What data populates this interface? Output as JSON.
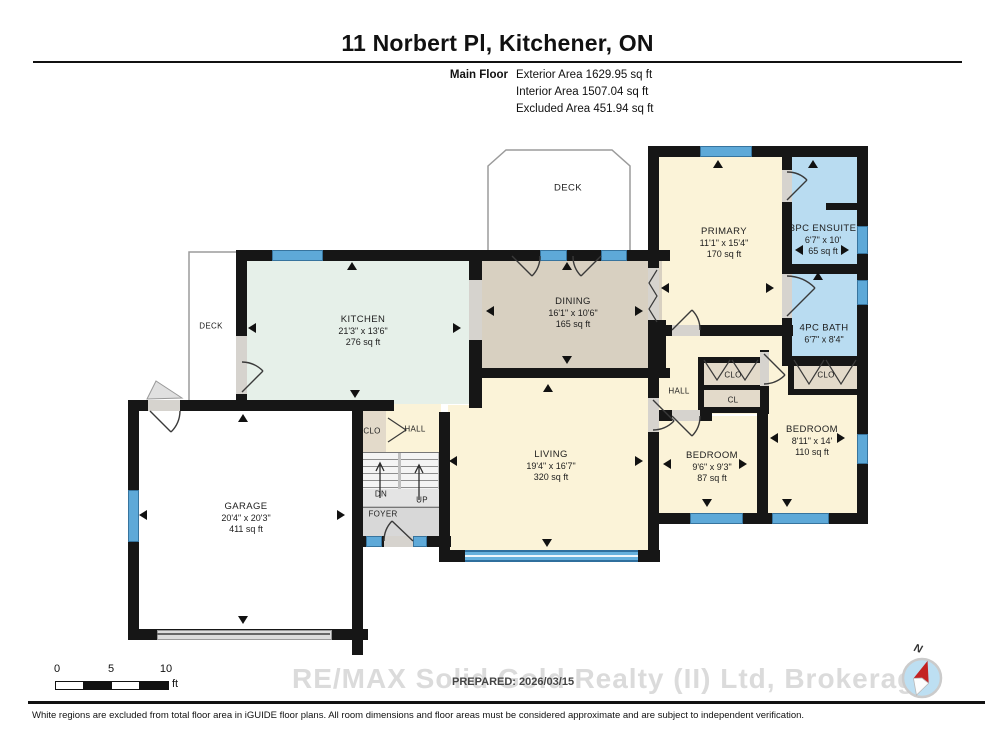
{
  "header": {
    "title": "11 Norbert Pl, Kitchener, ON",
    "floor_label": "Main Floor",
    "stats": [
      "Exterior Area 1629.95 sq ft",
      "Interior Area 1507.04 sq ft",
      "Excluded Area 451.94 sq ft"
    ]
  },
  "rooms": {
    "deck_top": {
      "name": "DECK"
    },
    "deck_left": {
      "name": "DECK"
    },
    "primary": {
      "name": "PRIMARY",
      "dims": "11'1\" x 15'4\"",
      "area": "170 sq ft"
    },
    "ensuite": {
      "name": "3PC ENSUITE",
      "dims": "6'7\" x 10'",
      "area": "65 sq ft"
    },
    "bath": {
      "name": "4PC BATH",
      "dims": "6'7\" x 8'4\""
    },
    "kitchen": {
      "name": "KITCHEN",
      "dims": "21'3\" x 13'6\"",
      "area": "276 sq ft"
    },
    "dining": {
      "name": "DINING",
      "dims": "16'1\" x 10'6\"",
      "area": "165 sq ft"
    },
    "living": {
      "name": "LIVING",
      "dims": "19'4\" x 16'7\"",
      "area": "320 sq ft"
    },
    "garage": {
      "name": "GARAGE",
      "dims": "20'4\" x 20'3\"",
      "area": "411 sq ft"
    },
    "bedroom1": {
      "name": "BEDROOM",
      "dims": "9'6\" x 9'3\"",
      "area": "87 sq ft"
    },
    "bedroom2": {
      "name": "BEDROOM",
      "dims": "8'11\" x 14'",
      "area": "110 sq ft"
    },
    "hall_right": {
      "name": "HALL"
    },
    "hall_mid": {
      "name": "HALL"
    },
    "foyer": {
      "name": "FOYER"
    },
    "closet_hall": {
      "name": "CLO"
    },
    "closet_hall_2": {
      "name": "CL"
    },
    "closet_bedroom2": {
      "name": "CLO"
    },
    "closet_garage": {
      "name": "CLO"
    },
    "stairs_down": {
      "name": "DN"
    },
    "stairs_up": {
      "name": "UP"
    }
  },
  "colors": {
    "wall": "#161616",
    "room_cream": "#FBF3D8",
    "room_mint": "#E6F0E9",
    "room_tan": "#D8D0C1",
    "closet_tan": "#E3DACA",
    "room_blue": "#B9DCF1",
    "window_blue": "#5EA9D8",
    "floor_gray": "#D8D8D8",
    "compass_red": "#C32222"
  },
  "footer": {
    "scale": {
      "ticks": [
        "0",
        "5",
        "10"
      ],
      "unit": "ft"
    },
    "prepared": "PREPARED: 2026/03/15",
    "watermark": "RE/MAX Solid Gold Realty (II) Ltd, Brokerage",
    "disclaimer": "White regions are excluded from total floor area in iGUIDE floor plans. All room dimensions and floor areas must be considered approximate and are subject to independent verification.",
    "compass_north": "N"
  }
}
